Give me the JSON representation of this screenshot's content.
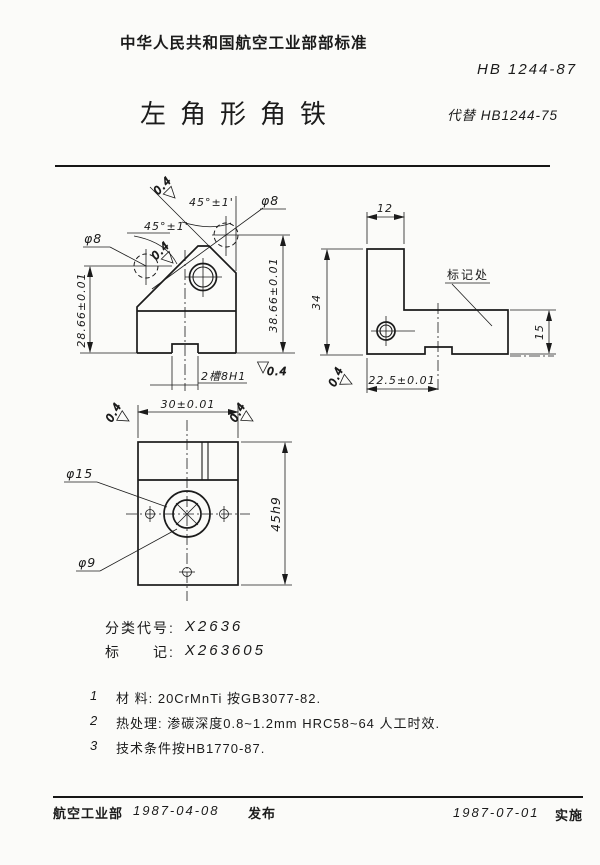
{
  "header": {
    "org": "中华人民共和国航空工业部部标准",
    "code": "HB 1244-87",
    "title": "左角形角铁",
    "replaces": "代替 HB1244-75"
  },
  "drawing": {
    "roughness": "0.4",
    "angle": "45°±1'",
    "front": {
      "hole_left": "φ8",
      "hole_top": "φ8",
      "dim_left": "28.66±0.01",
      "dim_right": "38.66±0.01",
      "slot": "2槽8H1"
    },
    "side": {
      "dim_top": "12",
      "dim_left": "34",
      "dim_right": "15",
      "dim_bottom": "22.5±0.01",
      "mark": "标记处"
    },
    "plan": {
      "dim_top": "30±0.01",
      "dim_right": "45h9",
      "bore_outer": "φ15",
      "bore_inner": "φ9"
    }
  },
  "classification": {
    "code_label": "分类代号:",
    "code_value": "X2636",
    "mark_label": "标　　记:",
    "mark_value": "X263605"
  },
  "notes": [
    {
      "num": "1",
      "text": "材 料: 20CrMnTi  按GB3077-82."
    },
    {
      "num": "2",
      "text": "热处理: 渗碳深度0.8~1.2mm  HRC58~64  人工时效."
    },
    {
      "num": "3",
      "text": "技术条件按HB1770-87."
    }
  ],
  "footer": {
    "org": "航空工业部",
    "release_date": "1987-04-08",
    "release": "发布",
    "impl_date": "1987-07-01",
    "impl": "实施"
  }
}
